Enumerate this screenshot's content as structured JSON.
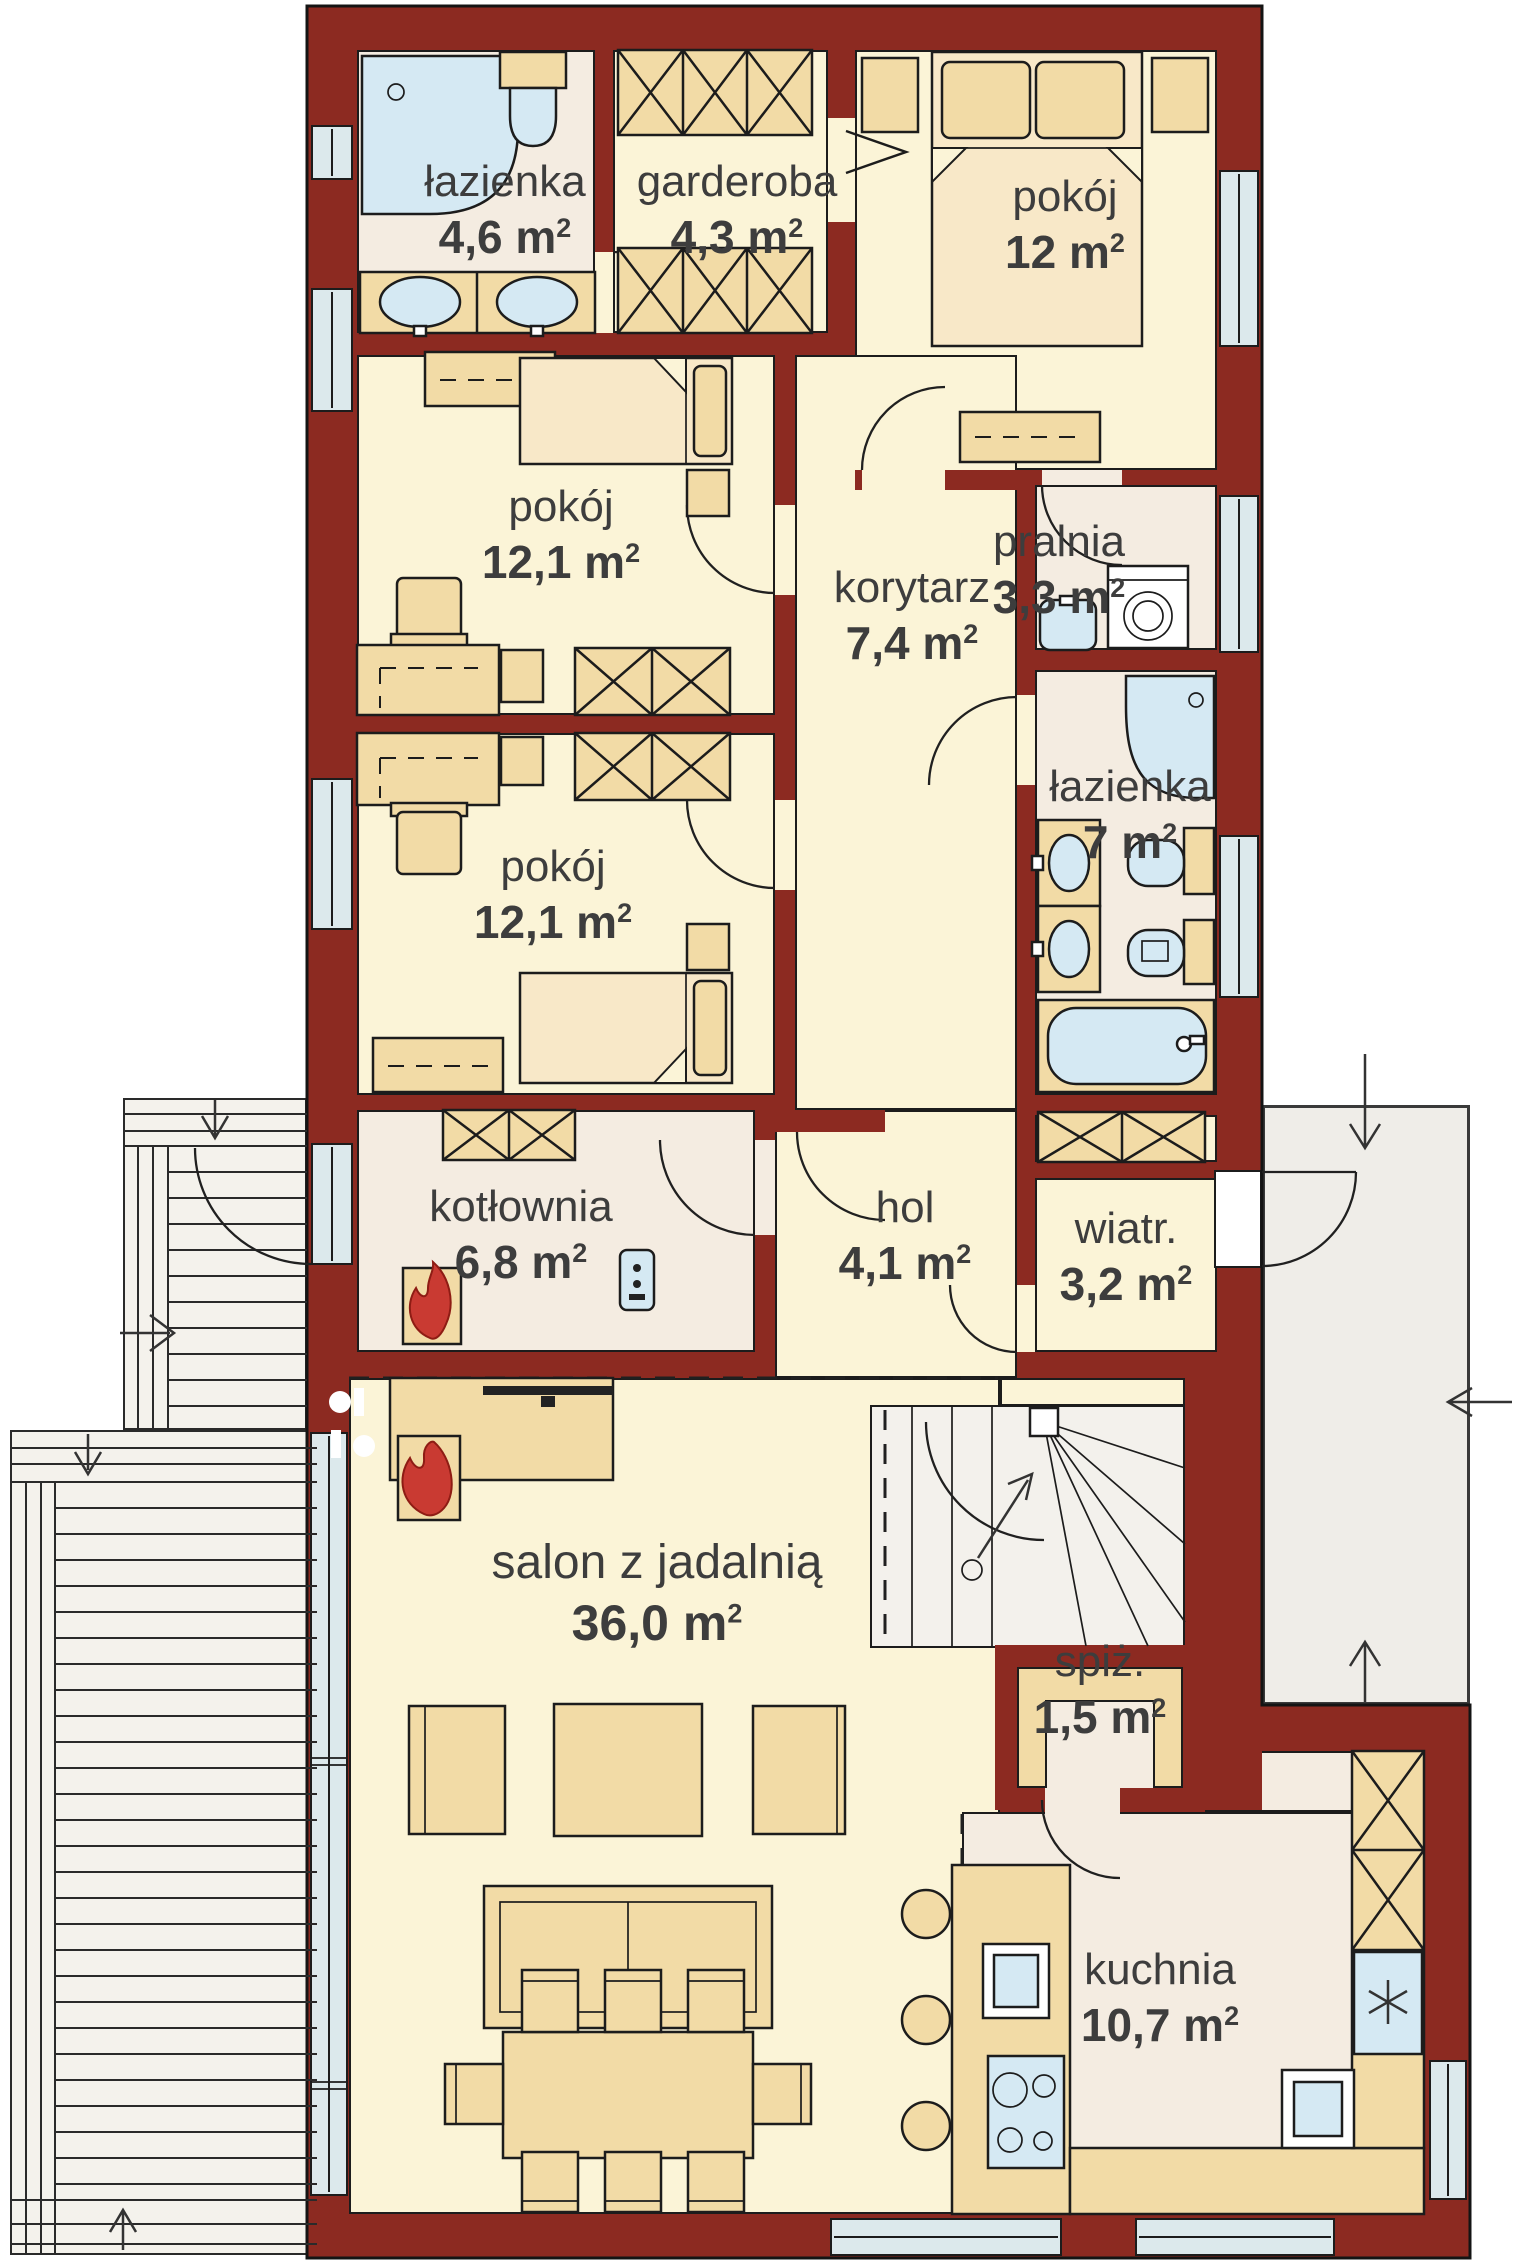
{
  "plan": {
    "sup": "2",
    "rooms": [
      {
        "id": "lazienka-gorna",
        "name": "łazienka",
        "area": "4,6 m"
      },
      {
        "id": "garderoba",
        "name": "garderoba",
        "area": "4,3 m"
      },
      {
        "id": "pokoj-12",
        "name": "pokój",
        "area": "12 m"
      },
      {
        "id": "pokoj-12-1-a",
        "name": "pokój",
        "area": "12,1 m"
      },
      {
        "id": "korytarz",
        "name": "korytarz",
        "area": "7,4 m"
      },
      {
        "id": "pralnia",
        "name": "pralnia",
        "area": "3,3 m"
      },
      {
        "id": "lazienka-dolna",
        "name": "łazienka",
        "area": "7 m"
      },
      {
        "id": "pokoj-12-1-b",
        "name": "pokój",
        "area": "12,1 m"
      },
      {
        "id": "kotlownia",
        "name": "kotłownia",
        "area": "6,8 m"
      },
      {
        "id": "hol",
        "name": "hol",
        "area": "4,1 m"
      },
      {
        "id": "wiatrolap",
        "name": "wiatr.",
        "area": "3,2 m"
      },
      {
        "id": "salon",
        "name": "salon z jadalnią",
        "area": "36,0 m"
      },
      {
        "id": "spizarnia",
        "name": "spiż.",
        "area": "1,5 m"
      },
      {
        "id": "kuchnia",
        "name": "kuchnia",
        "area": "10,7 m"
      }
    ],
    "colors": {
      "wall": "#8C2A21",
      "floor_room": "#FBF4D7",
      "floor_service": "#F4ECE1",
      "furniture": "#F2DBA6",
      "furniture_light": "#F8E8C8",
      "fixture_blue": "#D5E9F3",
      "window": "#DCE9EC",
      "porch": "#EFEDE8",
      "deck": "#F4F2EC",
      "flame": "#C93A32",
      "outline": "#1C1C1C",
      "text": "#3D3D3D"
    }
  }
}
